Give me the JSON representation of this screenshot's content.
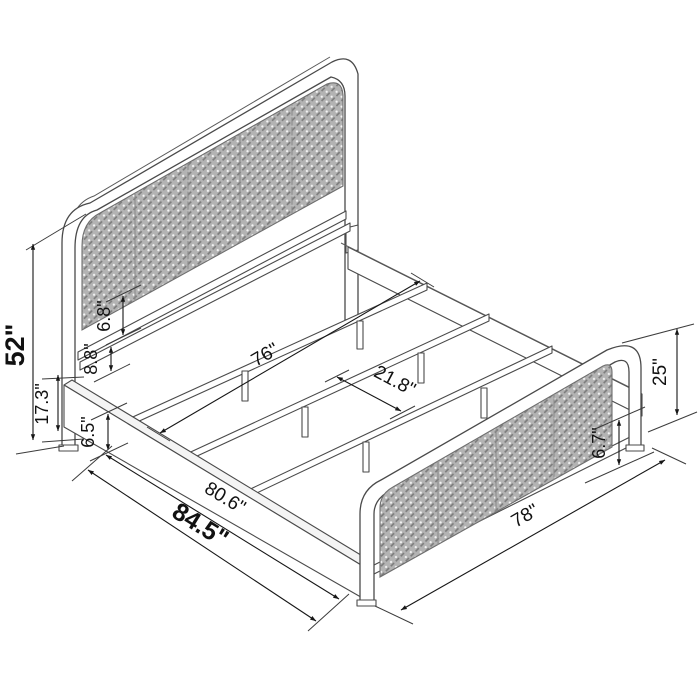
{
  "diagram": {
    "type": "isometric-bed-frame-dimension-drawing",
    "dimensions": {
      "headboard_total_height": "52\"",
      "floor_to_rail_top": "17.3\"",
      "headboard_panel_gap": "6.8\"",
      "headboard_bar_gap": "8.8\"",
      "side_rail_height": "6.5\"",
      "slat_length": "76\"",
      "slat_spacing": "21.8\"",
      "inner_length": "80.6\"",
      "total_length": "84.5\"",
      "footboard_height": "25\"",
      "footboard_clearance": "6.7\"",
      "total_width": "78\""
    },
    "colors": {
      "line": "#4a4a4a",
      "dimension_line": "#161616",
      "text": "#111111",
      "cane_mesh": "#b3b3b3",
      "background": "#ffffff"
    }
  }
}
